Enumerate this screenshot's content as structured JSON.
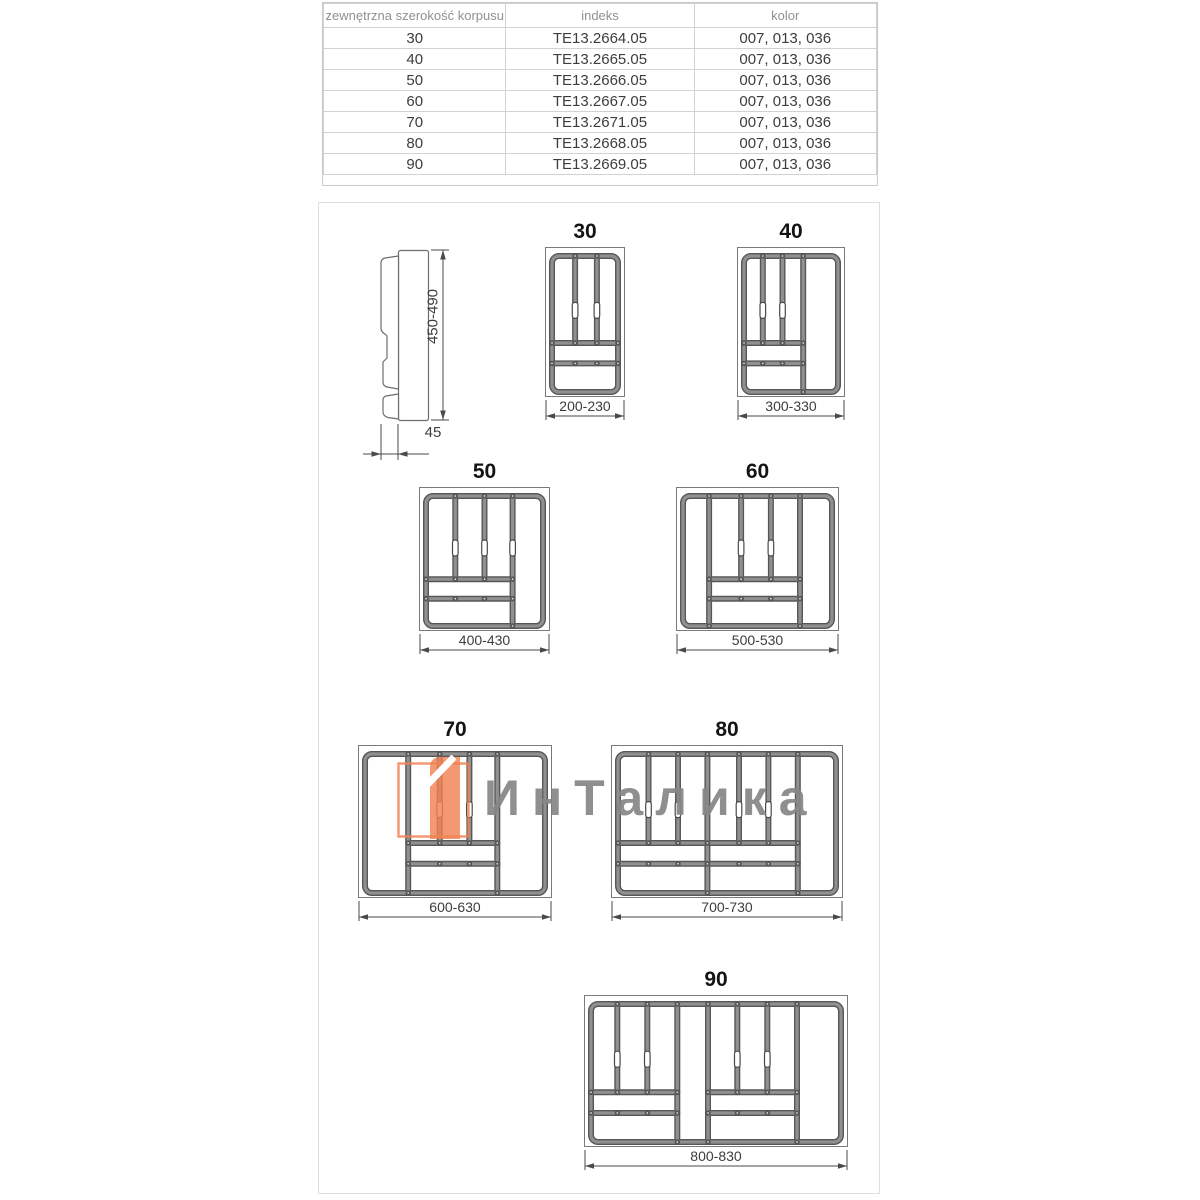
{
  "spec_table": {
    "headers": [
      "zewnętrzna szerokość korpusu",
      "indeks",
      "kolor"
    ],
    "rows": [
      [
        "30",
        "TE13.2664.05",
        "007, 013, 036"
      ],
      [
        "40",
        "TE13.2665.05",
        "007, 013, 036"
      ],
      [
        "50",
        "TE13.2666.05",
        "007, 013, 036"
      ],
      [
        "60",
        "TE13.2667.05",
        "007, 013, 036"
      ],
      [
        "70",
        "TE13.2671.05",
        "007, 013, 036"
      ],
      [
        "80",
        "TE13.2668.05",
        "007, 013, 036"
      ],
      [
        "90",
        "TE13.2669.05",
        "007, 013, 036"
      ]
    ]
  },
  "side_view": {
    "height_dim": "450-490",
    "depth_dim": "45"
  },
  "watermark": {
    "text": "ИнТалика",
    "accent_color": "#ef8050",
    "text_color": "#868686"
  },
  "drawing_colors": {
    "wall_dark": "#575757",
    "wall_light": "#909090",
    "outline": "#7a7a7a",
    "dim": "#4a4a4a"
  },
  "trays": [
    {
      "size_label": "30",
      "width_dim": "200-230",
      "rect": [
        545,
        247,
        80,
        150
      ],
      "vwalls": [
        [
          0.35,
          0,
          0.64
        ],
        [
          0.68,
          0,
          0.64
        ]
      ],
      "hwalls": [
        [
          0.64,
          0,
          1
        ],
        [
          0.79,
          0,
          1
        ]
      ],
      "pills": [
        [
          0.35,
          0.4
        ],
        [
          0.68,
          0.4
        ]
      ]
    },
    {
      "size_label": "40",
      "width_dim": "300-330",
      "rect": [
        737,
        247,
        108,
        150
      ],
      "vwalls": [
        [
          0.2,
          0,
          0.64
        ],
        [
          0.41,
          0,
          0.64
        ],
        [
          0.63,
          0,
          1
        ]
      ],
      "hwalls": [
        [
          0.64,
          0,
          0.63
        ],
        [
          0.79,
          0,
          0.63
        ]
      ],
      "pills": [
        [
          0.2,
          0.4
        ],
        [
          0.41,
          0.4
        ]
      ]
    },
    {
      "size_label": "50",
      "width_dim": "400-430",
      "rect": [
        419,
        487,
        131,
        144
      ],
      "vwalls": [
        [
          0.25,
          0,
          0.64
        ],
        [
          0.5,
          0,
          0.64
        ],
        [
          0.74,
          0,
          1
        ]
      ],
      "hwalls": [
        [
          0.64,
          0,
          0.74
        ],
        [
          0.79,
          0,
          0.74
        ]
      ],
      "pills": [
        [
          0.25,
          0.4
        ],
        [
          0.5,
          0.4
        ],
        [
          0.74,
          0.4
        ]
      ]
    },
    {
      "size_label": "60",
      "width_dim": "500-530",
      "rect": [
        676,
        487,
        163,
        144
      ],
      "vwalls": [
        [
          0.175,
          0,
          1
        ],
        [
          0.39,
          0,
          0.64
        ],
        [
          0.59,
          0,
          0.64
        ],
        [
          0.785,
          0,
          1
        ]
      ],
      "hwalls": [
        [
          0.64,
          0.175,
          0.785
        ],
        [
          0.79,
          0.175,
          0.785
        ]
      ],
      "pills": [
        [
          0.39,
          0.4
        ],
        [
          0.59,
          0.4
        ]
      ]
    },
    {
      "size_label": "70",
      "width_dim": "600-630",
      "rect": [
        358,
        745,
        194,
        153
      ],
      "vwalls": [
        [
          0.24,
          0,
          1
        ],
        [
          0.415,
          0,
          0.64
        ],
        [
          0.58,
          0,
          0.64
        ],
        [
          0.735,
          0,
          1
        ]
      ],
      "hwalls": [
        [
          0.64,
          0.24,
          0.735
        ],
        [
          0.79,
          0.24,
          0.735
        ]
      ],
      "pills": [
        [
          0.415,
          0.4
        ],
        [
          0.58,
          0.4
        ]
      ]
    },
    {
      "size_label": "80",
      "width_dim": "700-730",
      "rect": [
        611,
        745,
        232,
        153
      ],
      "vwalls": [
        [
          0.14,
          0,
          0.64
        ],
        [
          0.275,
          0,
          0.64
        ],
        [
          0.41,
          0,
          1
        ],
        [
          0.555,
          0,
          0.64
        ],
        [
          0.69,
          0,
          0.64
        ],
        [
          0.825,
          0,
          1
        ]
      ],
      "hwalls": [
        [
          0.64,
          0,
          0.41
        ],
        [
          0.79,
          0,
          0.41
        ],
        [
          0.64,
          0.41,
          0.825
        ],
        [
          0.79,
          0.41,
          0.825
        ]
      ],
      "pills": [
        [
          0.14,
          0.4
        ],
        [
          0.275,
          0.4
        ],
        [
          0.555,
          0.4
        ],
        [
          0.69,
          0.4
        ]
      ]
    },
    {
      "size_label": "90",
      "width_dim": "800-830",
      "rect": [
        584,
        995,
        264,
        152
      ],
      "vwalls": [
        [
          0.105,
          0,
          0.64
        ],
        [
          0.225,
          0,
          0.64
        ],
        [
          0.345,
          0,
          1
        ],
        [
          0.468,
          0,
          1
        ],
        [
          0.585,
          0,
          0.64
        ],
        [
          0.705,
          0,
          0.64
        ],
        [
          0.824,
          0,
          1
        ]
      ],
      "hwalls": [
        [
          0.64,
          0,
          0.345
        ],
        [
          0.79,
          0,
          0.345
        ],
        [
          0.64,
          0.468,
          0.824
        ],
        [
          0.79,
          0.468,
          0.824
        ]
      ],
      "pills": [
        [
          0.105,
          0.4
        ],
        [
          0.225,
          0.4
        ],
        [
          0.585,
          0.4
        ],
        [
          0.705,
          0.4
        ]
      ]
    }
  ]
}
